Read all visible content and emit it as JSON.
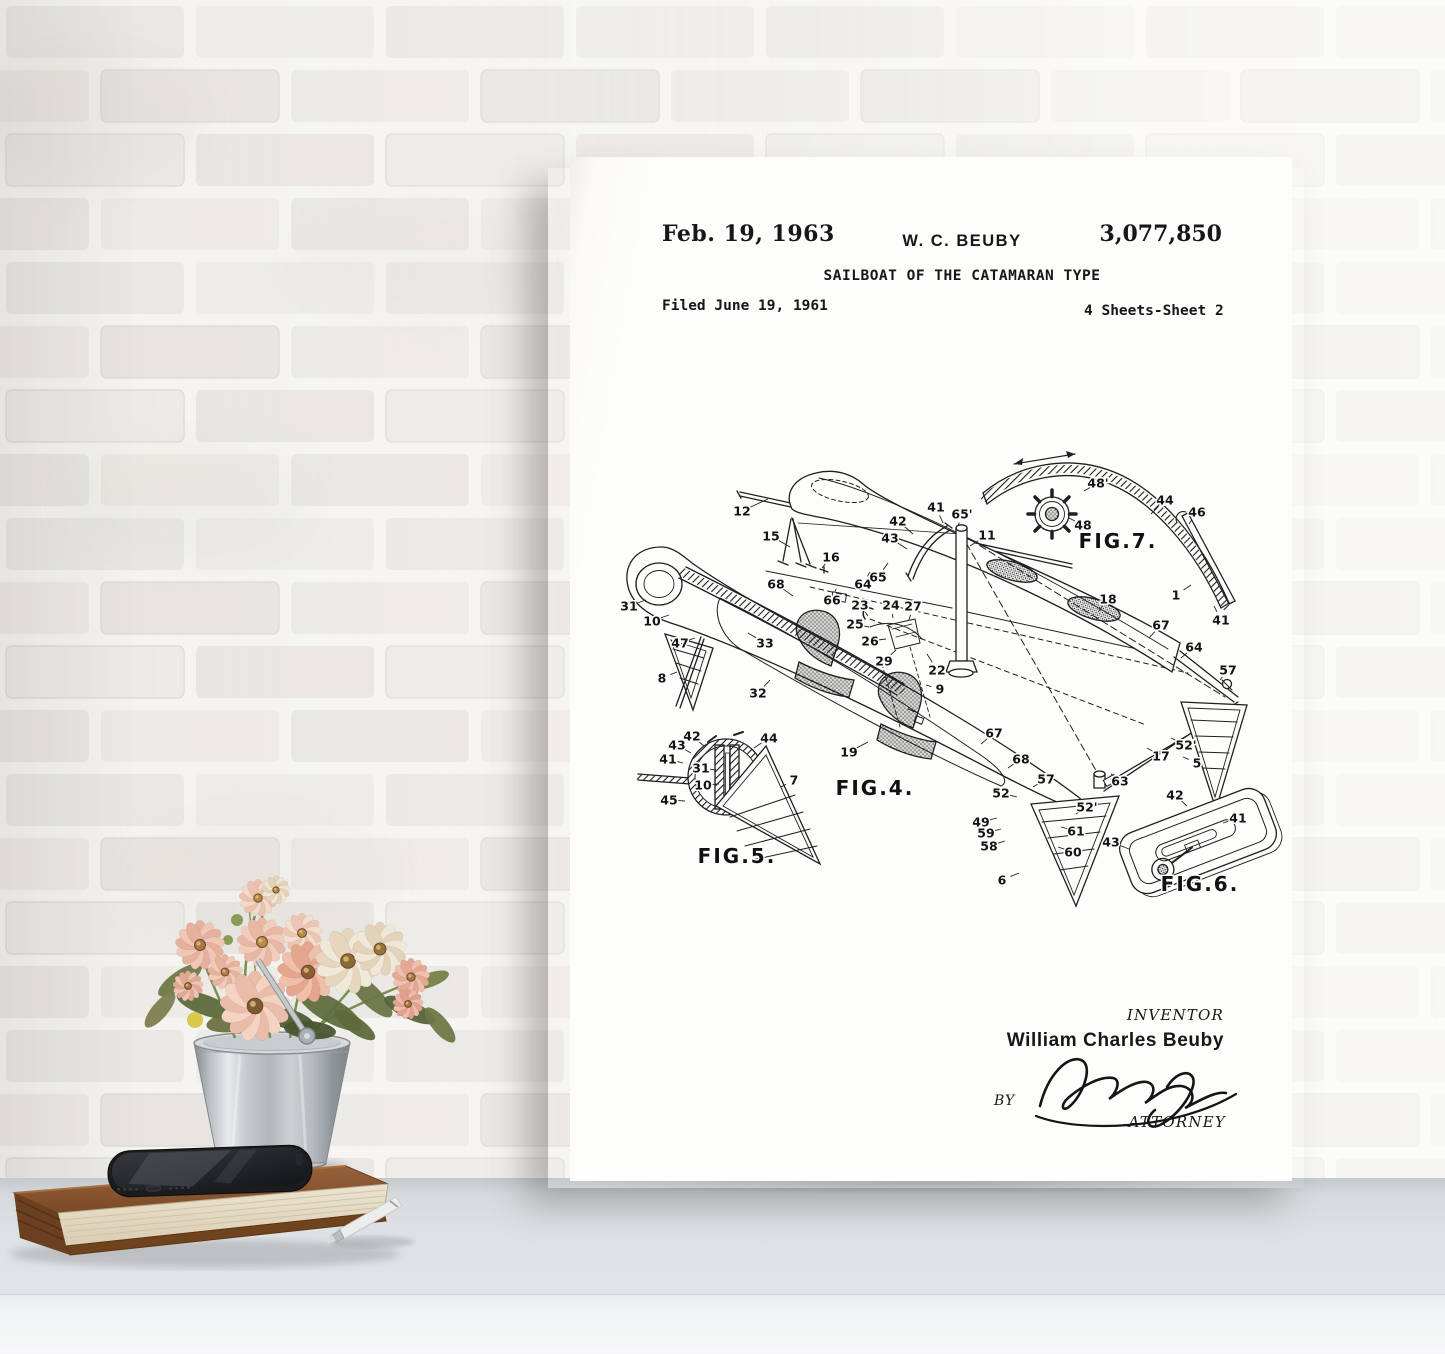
{
  "poster": {
    "header": {
      "date": "Feb. 19, 1963",
      "inventor_short": "W. C. BEUBY",
      "patent_number": "3,077,850",
      "title": "SAILBOAT OF THE CATAMARAN TYPE",
      "filed": "Filed June 19, 1961",
      "sheets": "4 Sheets-Sheet 2"
    },
    "figures": [
      {
        "label": "FIG.7.",
        "x": 548,
        "y": 391
      },
      {
        "label": "FIG.4.",
        "x": 305,
        "y": 638
      },
      {
        "label": "FIG.5.",
        "x": 167,
        "y": 706
      },
      {
        "label": "FIG.6.",
        "x": 630,
        "y": 734
      }
    ],
    "part_labels": [
      {
        "t": "12",
        "x": 172,
        "y": 354,
        "tx": 198,
        "ty": 342
      },
      {
        "t": "15",
        "x": 201,
        "y": 379,
        "tx": 220,
        "ty": 390
      },
      {
        "t": "16",
        "x": 261,
        "y": 400,
        "tx": 252,
        "ty": 411
      },
      {
        "t": "68",
        "x": 206,
        "y": 427,
        "tx": 223,
        "ty": 439
      },
      {
        "t": "66",
        "x": 262,
        "y": 443,
        "tx": 266,
        "ty": 432
      },
      {
        "t": "64",
        "x": 293,
        "y": 427,
        "tx": 300,
        "ty": 415
      },
      {
        "t": "65",
        "x": 308,
        "y": 420,
        "tx": 318,
        "ty": 406
      },
      {
        "t": "42",
        "x": 328,
        "y": 364,
        "tx": 343,
        "ty": 377
      },
      {
        "t": "43",
        "x": 320,
        "y": 381,
        "tx": 337,
        "ty": 392
      },
      {
        "t": "41",
        "x": 366,
        "y": 350,
        "tx": 373,
        "ty": 366
      },
      {
        "t": "65'",
        "x": 392,
        "y": 357,
        "tx": 388,
        "ty": 369
      },
      {
        "t": "11",
        "x": 417,
        "y": 378,
        "tx": 400,
        "ty": 389
      },
      {
        "t": "31",
        "x": 59,
        "y": 449,
        "tx": 76,
        "ty": 443
      },
      {
        "t": "10",
        "x": 82,
        "y": 464,
        "tx": 99,
        "ty": 458
      },
      {
        "t": "47",
        "x": 110,
        "y": 486,
        "tx": 125,
        "ty": 481
      },
      {
        "t": "33",
        "x": 195,
        "y": 486,
        "tx": 178,
        "ty": 476
      },
      {
        "t": "8",
        "x": 92,
        "y": 521,
        "tx": 107,
        "ty": 515
      },
      {
        "t": "32",
        "x": 188,
        "y": 536,
        "tx": 200,
        "ty": 523
      },
      {
        "t": "23",
        "x": 290,
        "y": 448,
        "tx": 298,
        "ty": 459
      },
      {
        "t": "24",
        "x": 321,
        "y": 448,
        "tx": 323,
        "ty": 461
      },
      {
        "t": "27",
        "x": 343,
        "y": 449,
        "tx": 339,
        "ty": 463
      },
      {
        "t": "25",
        "x": 285,
        "y": 467,
        "tx": 299,
        "ty": 470
      },
      {
        "t": "26",
        "x": 300,
        "y": 484,
        "tx": 316,
        "ty": 482
      },
      {
        "t": "29",
        "x": 314,
        "y": 504,
        "tx": 326,
        "ty": 493
      },
      {
        "t": "22",
        "x": 367,
        "y": 513,
        "tx": 357,
        "ty": 497
      },
      {
        "t": "9",
        "x": 370,
        "y": 532,
        "tx": 356,
        "ty": 528
      },
      {
        "t": "19",
        "x": 279,
        "y": 595,
        "tx": 298,
        "ty": 585
      },
      {
        "t": "48'",
        "x": 528,
        "y": 326,
        "tx": 514,
        "ty": 334
      },
      {
        "t": "48",
        "x": 513,
        "y": 368,
        "tx": 499,
        "ty": 361
      },
      {
        "t": "44",
        "x": 595,
        "y": 343,
        "tx": 581,
        "ty": 357
      },
      {
        "t": "46",
        "x": 627,
        "y": 355,
        "tx": 619,
        "ty": 367
      },
      {
        "t": "1",
        "x": 606,
        "y": 438,
        "tx": 621,
        "ty": 428
      },
      {
        "t": "41",
        "x": 651,
        "y": 463,
        "tx": 644,
        "ty": 449
      },
      {
        "t": "18",
        "x": 538,
        "y": 442,
        "tx": 529,
        "ty": 454
      },
      {
        "t": "67",
        "x": 591,
        "y": 468,
        "tx": 579,
        "ty": 481
      },
      {
        "t": "64",
        "x": 624,
        "y": 490,
        "tx": 611,
        "ty": 501
      },
      {
        "t": "57",
        "x": 658,
        "y": 513,
        "tx": 650,
        "ty": 523
      },
      {
        "t": "52'",
        "x": 616,
        "y": 588,
        "tx": 601,
        "ty": 581
      },
      {
        "t": "17",
        "x": 591,
        "y": 599,
        "tx": 577,
        "ty": 591
      },
      {
        "t": "5",
        "x": 627,
        "y": 606,
        "tx": 613,
        "ty": 600
      },
      {
        "t": "63",
        "x": 550,
        "y": 624,
        "tx": 541,
        "ty": 617
      },
      {
        "t": "67",
        "x": 424,
        "y": 576,
        "tx": 411,
        "ty": 587
      },
      {
        "t": "68",
        "x": 451,
        "y": 602,
        "tx": 438,
        "ty": 611
      },
      {
        "t": "57",
        "x": 476,
        "y": 622,
        "tx": 463,
        "ty": 630
      },
      {
        "t": "52",
        "x": 431,
        "y": 636,
        "tx": 447,
        "ty": 640
      },
      {
        "t": "49",
        "x": 411,
        "y": 665,
        "tx": 427,
        "ty": 661
      },
      {
        "t": "59",
        "x": 416,
        "y": 676,
        "tx": 431,
        "ty": 672
      },
      {
        "t": "58",
        "x": 419,
        "y": 689,
        "tx": 435,
        "ty": 684
      },
      {
        "t": "6",
        "x": 432,
        "y": 723,
        "tx": 449,
        "ty": 716
      },
      {
        "t": "61",
        "x": 506,
        "y": 674,
        "tx": 491,
        "ty": 670
      },
      {
        "t": "60",
        "x": 503,
        "y": 695,
        "tx": 488,
        "ty": 690
      },
      {
        "t": "52'",
        "x": 517,
        "y": 650,
        "tx": 506,
        "ty": 657
      },
      {
        "t": "42",
        "x": 122,
        "y": 579,
        "tx": 134,
        "ty": 589
      },
      {
        "t": "43",
        "x": 107,
        "y": 588,
        "tx": 121,
        "ty": 596
      },
      {
        "t": "41",
        "x": 98,
        "y": 602,
        "tx": 113,
        "ty": 606
      },
      {
        "t": "44",
        "x": 199,
        "y": 581,
        "tx": 184,
        "ty": 591
      },
      {
        "t": "31",
        "x": 131,
        "y": 611,
        "tx": 146,
        "ty": 613
      },
      {
        "t": "10",
        "x": 133,
        "y": 628,
        "tx": 149,
        "ty": 627
      },
      {
        "t": "45",
        "x": 99,
        "y": 643,
        "tx": 115,
        "ty": 644
      },
      {
        "t": "7",
        "x": 224,
        "y": 623,
        "tx": 211,
        "ty": 630
      },
      {
        "t": "42",
        "x": 605,
        "y": 638,
        "tx": 617,
        "ty": 649
      },
      {
        "t": "41",
        "x": 668,
        "y": 661,
        "tx": 653,
        "ty": 666
      },
      {
        "t": "43",
        "x": 541,
        "y": 685,
        "tx": 559,
        "ty": 692
      }
    ],
    "signature": {
      "inventor_heading": "INVENTOR",
      "inventor_name": "William Charles Beuby",
      "by_label": "BY",
      "signature_name": "Raymond Jones",
      "attorney_label": "ATTORNEY"
    }
  },
  "props": {
    "flowers": [
      {
        "x": 258,
        "y": 38,
        "r": 16,
        "p1": "#f3d9c8",
        "p2": "#eac2ae",
        "c": "#b98a4e"
      },
      {
        "x": 276,
        "y": 30,
        "r": 12,
        "p1": "#f1e6d4",
        "p2": "#e6d2ba",
        "c": "#b98a4e"
      },
      {
        "x": 200,
        "y": 85,
        "r": 21,
        "p1": "#f0c6b4",
        "p2": "#e7b09c",
        "c": "#a9764a"
      },
      {
        "x": 188,
        "y": 126,
        "r": 13,
        "p1": "#eec3b2",
        "p2": "#e3a893",
        "c": "#a9764a"
      },
      {
        "x": 262,
        "y": 82,
        "r": 21,
        "p1": "#f2cdbb",
        "p2": "#e9b7a3",
        "c": "#b98a4e"
      },
      {
        "x": 302,
        "y": 73,
        "r": 17,
        "p1": "#f4ddcb",
        "p2": "#ebc6b2",
        "c": "#b98a4e"
      },
      {
        "x": 225,
        "y": 112,
        "r": 15,
        "p1": "#f1cab8",
        "p2": "#e7b29e",
        "c": "#b08050"
      },
      {
        "x": 308,
        "y": 112,
        "r": 26,
        "p1": "#f0bfa9",
        "p2": "#e5a68e",
        "c": "#8a5f35"
      },
      {
        "x": 348,
        "y": 101,
        "r": 28,
        "p1": "#f1e9d8",
        "p2": "#e5d6bd",
        "c": "#8a6a38"
      },
      {
        "x": 380,
        "y": 89,
        "r": 23,
        "p1": "#f0e7d6",
        "p2": "#e3d3ba",
        "c": "#96743c"
      },
      {
        "x": 411,
        "y": 117,
        "r": 16,
        "p1": "#efc0ae",
        "p2": "#e4a893",
        "c": "#a9764a"
      },
      {
        "x": 408,
        "y": 144,
        "r": 13,
        "p1": "#eebbab",
        "p2": "#e2a18c",
        "c": "#a9764a"
      },
      {
        "x": 255,
        "y": 146,
        "r": 30,
        "p1": "#f4d3c2",
        "p2": "#eabcaa",
        "c": "#7d5a33"
      }
    ],
    "leaves": [
      {
        "x": 180,
        "y": 120,
        "rx": 26,
        "ry": 9,
        "rot": -35,
        "c": "#6f7846"
      },
      {
        "x": 205,
        "y": 145,
        "rx": 30,
        "ry": 10,
        "rot": 20,
        "c": "#5d6a3c"
      },
      {
        "x": 240,
        "y": 160,
        "rx": 34,
        "ry": 11,
        "rot": -10,
        "c": "#6b7040"
      },
      {
        "x": 285,
        "y": 158,
        "rx": 30,
        "ry": 10,
        "rot": 15,
        "c": "#4f5c33"
      },
      {
        "x": 330,
        "y": 150,
        "rx": 36,
        "ry": 12,
        "rot": 30,
        "c": "#5f6e3e"
      },
      {
        "x": 370,
        "y": 135,
        "rx": 30,
        "ry": 10,
        "rot": 45,
        "c": "#6b7544"
      },
      {
        "x": 410,
        "y": 150,
        "rx": 28,
        "ry": 9,
        "rot": 25,
        "c": "#57643a"
      },
      {
        "x": 440,
        "y": 165,
        "rx": 22,
        "ry": 8,
        "rot": 50,
        "c": "#6f7846"
      },
      {
        "x": 160,
        "y": 150,
        "rx": 22,
        "ry": 8,
        "rot": -50,
        "c": "#7c8050"
      },
      {
        "x": 310,
        "y": 170,
        "rx": 26,
        "ry": 9,
        "rot": 5,
        "c": "#49552f"
      },
      {
        "x": 355,
        "y": 165,
        "rx": 24,
        "ry": 8,
        "rot": 35,
        "c": "#5d6a3c"
      },
      {
        "x": 430,
        "y": 120,
        "rx": 20,
        "ry": 7,
        "rot": -20,
        "c": "#768149"
      }
    ],
    "colors": {
      "bucket_metal": "#c7ccd0",
      "book_cover": "#8a5731",
      "book_pages": "#e9e1cd",
      "phone_body": "#1a1c1e",
      "pen_barrel": "#eceded",
      "wall": "#f1efec",
      "table": "#dde1e4"
    }
  }
}
